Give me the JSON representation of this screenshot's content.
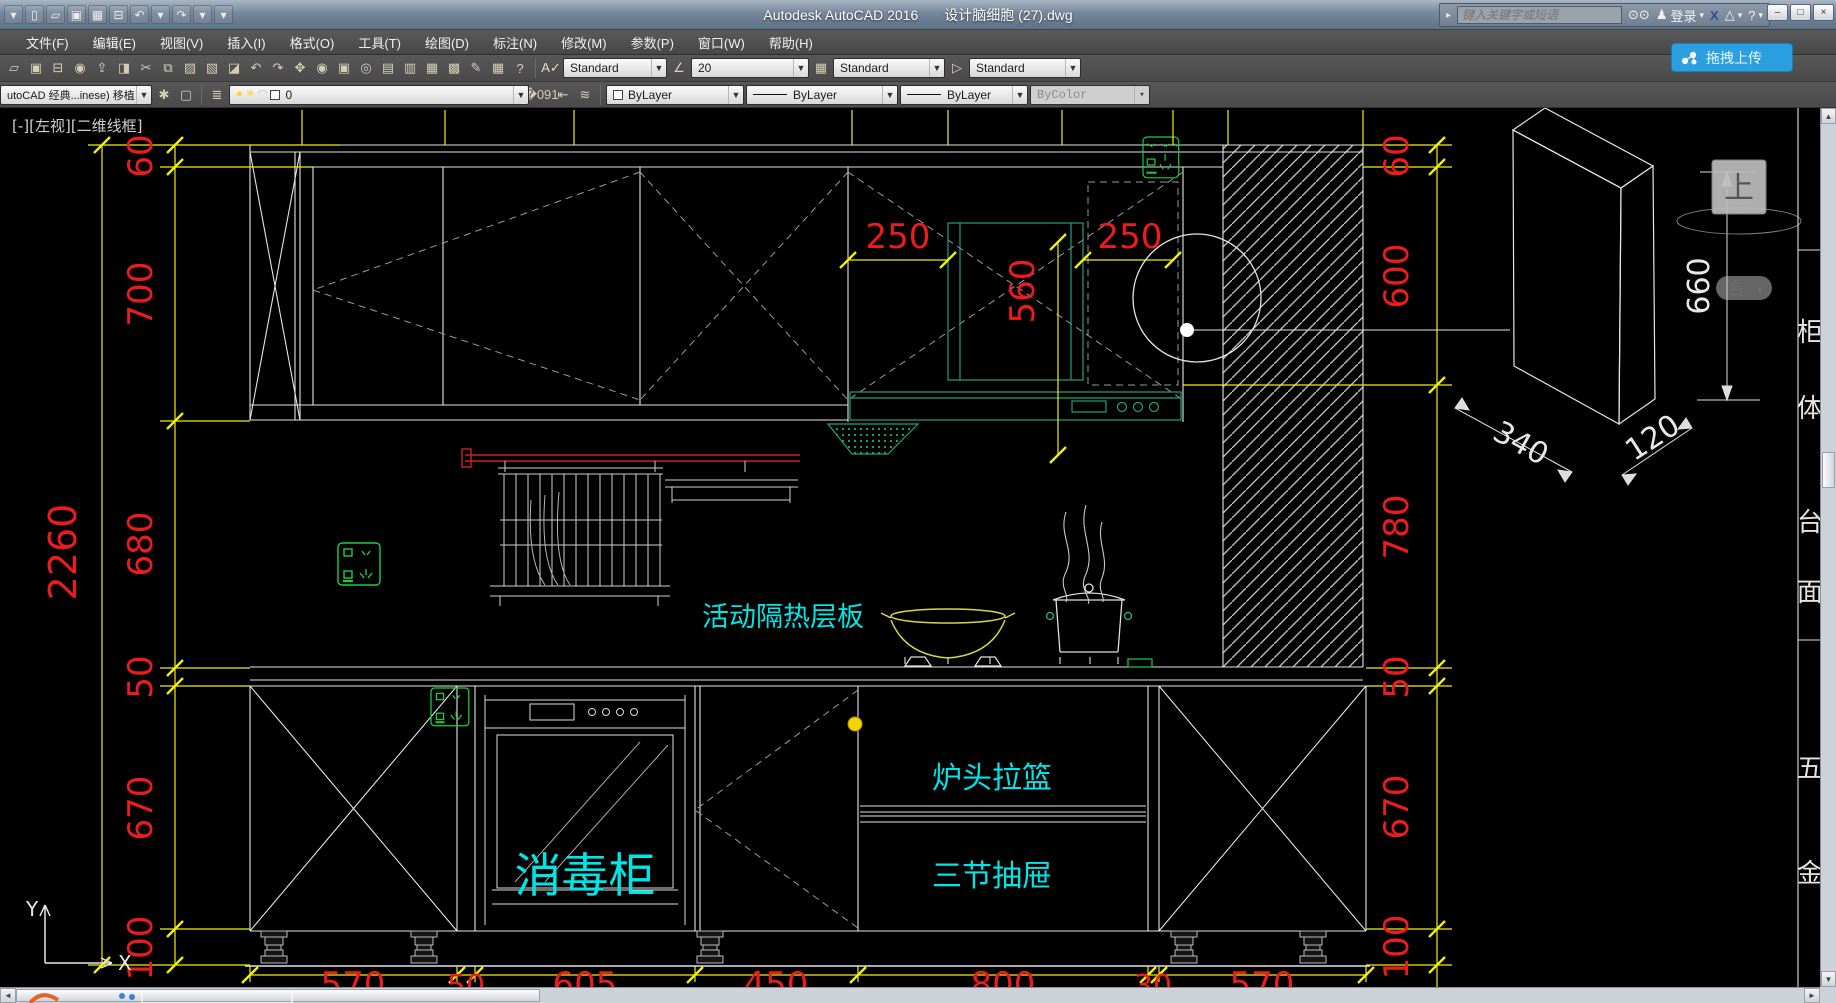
{
  "titlebar": {
    "app_title": "Autodesk AutoCAD 2016",
    "doc_name": "设计脑细胞 (27).dwg",
    "search_placeholder": "键入关键字或短语",
    "signin_label": "登录",
    "upload_label": "拖拽上传",
    "window_buttons": {
      "minimize": "–",
      "restore": "□",
      "close": "×"
    },
    "qat_icons": [
      {
        "name": "app-menu-arrow-icon",
        "glyph": "▾"
      },
      {
        "name": "new-file-icon",
        "glyph": "▯"
      },
      {
        "name": "open-file-icon",
        "glyph": "▱"
      },
      {
        "name": "save-icon",
        "glyph": "▣"
      },
      {
        "name": "save-as-icon",
        "glyph": "▦"
      },
      {
        "name": "plot-icon",
        "glyph": "⊟"
      },
      {
        "name": "undo-icon",
        "glyph": "↶"
      },
      {
        "name": "undo-dropdown-icon",
        "glyph": "▾"
      },
      {
        "name": "redo-icon",
        "glyph": "↷"
      },
      {
        "name": "redo-dropdown-icon",
        "glyph": "▾"
      },
      {
        "name": "qat-customize-icon",
        "glyph": "▾"
      }
    ],
    "infocenter_icons": [
      {
        "name": "search-binoculars-icon",
        "glyph": "⊙"
      },
      {
        "name": "sign-in-user-icon",
        "glyph": "♟"
      },
      {
        "name": "exchange-apps-icon",
        "glyph": "X"
      },
      {
        "name": "autodesk360-icon",
        "glyph": "▲"
      },
      {
        "name": "help-icon",
        "glyph": "?"
      }
    ]
  },
  "menubar": {
    "items": [
      "文件(F)",
      "编辑(E)",
      "视图(V)",
      "插入(I)",
      "格式(O)",
      "工具(T)",
      "绘图(D)",
      "标注(N)",
      "修改(M)",
      "参数(P)",
      "窗口(W)",
      "帮助(H)"
    ]
  },
  "toolbars": {
    "standard_icons": [
      {
        "name": "open-file-icon",
        "glyph": "▱"
      },
      {
        "name": "save-icon",
        "glyph": "▣"
      },
      {
        "name": "plot-icon",
        "glyph": "⊟"
      },
      {
        "name": "plot-preview-icon",
        "glyph": "◉"
      },
      {
        "name": "publish-icon",
        "glyph": "⇪"
      },
      {
        "name": "3d-dwf-icon",
        "glyph": "◨"
      },
      {
        "name": "cut-icon",
        "glyph": "✂"
      },
      {
        "name": "copy-icon",
        "glyph": "⧉"
      },
      {
        "name": "paste-icon",
        "glyph": "▨"
      },
      {
        "name": "match-properties-icon",
        "glyph": "▧"
      },
      {
        "name": "block-editor-icon",
        "glyph": "◪"
      },
      {
        "name": "undo-icon",
        "glyph": "↶"
      },
      {
        "name": "redo-icon",
        "glyph": "↷"
      },
      {
        "name": "pan-icon",
        "glyph": "✥"
      },
      {
        "name": "zoom-realtime-icon",
        "glyph": "◉"
      },
      {
        "name": "zoom-window-icon",
        "glyph": "▣"
      },
      {
        "name": "zoom-previous-icon",
        "glyph": "◎"
      },
      {
        "name": "properties-palette-icon",
        "glyph": "▤"
      },
      {
        "name": "design-center-icon",
        "glyph": "▥"
      },
      {
        "name": "tool-palettes-icon",
        "glyph": "▦"
      },
      {
        "name": "sheet-set-manager-icon",
        "glyph": "▩"
      },
      {
        "name": "markup-icon",
        "glyph": "✎"
      },
      {
        "name": "quick-calc-icon",
        "glyph": "▦"
      },
      {
        "name": "help-icon",
        "glyph": "?"
      }
    ],
    "text_style_label": "Standard",
    "dim_style_label": "20",
    "table_style_label": "Standard",
    "mleader_style_label": "Standard",
    "workspace_label": "utoCAD 经典...inese) 移植",
    "workspace_icons": [
      {
        "name": "workspace-settings-gear-icon",
        "glyph": "✱"
      },
      {
        "name": "ui-lock-icon",
        "glyph": "▢"
      }
    ],
    "layer_group_icons": [
      {
        "name": "layer-properties-manager-icon",
        "glyph": "≣"
      }
    ],
    "layer_state_icons": [
      {
        "name": "layer-on-bulb-icon",
        "glyph": "●"
      },
      {
        "name": "layer-thaw-sun-icon",
        "glyph": "✳"
      },
      {
        "name": "layer-unlock-icon",
        "glyph": "◠"
      }
    ],
    "layer_name": "0",
    "layer_tool_icons": [
      {
        "name": "make-object-layer-current-icon",
        "glyph": "�091"
      },
      {
        "name": "layer-previous-icon",
        "glyph": "⇤"
      },
      {
        "name": "layer-states-icon",
        "glyph": "≋"
      }
    ],
    "color_label": "ByLayer",
    "linetype_label": "ByLayer",
    "lineweight_label": "ByLayer",
    "plot_style_label": "ByColor"
  },
  "drawing": {
    "viewport_label": "[-][左视][二维线框]",
    "ucs": {
      "x_label": "X",
      "y_label": "Y"
    },
    "labels": {
      "insulation_shelf": "活动隔热层板",
      "sterilizer": "消毒柜",
      "stove_basket": "炉头拉篮",
      "three_drawer": "三节抽屉"
    },
    "dims": {
      "left_overall": "2260",
      "left": [
        "60",
        "700",
        "680",
        "50",
        "670",
        "100"
      ],
      "right": [
        "60",
        "600",
        "780",
        "50",
        "670",
        "100"
      ],
      "top": [
        "250",
        "560",
        "250"
      ],
      "bottom": [
        "570",
        "50",
        "605",
        "450",
        "800",
        "30",
        "570"
      ],
      "detail": {
        "width": "340",
        "depth": "120",
        "height": "660"
      }
    },
    "side_table_chars": [
      "柜",
      "体",
      "台",
      "面",
      "五",
      "金"
    ],
    "viewcube": {
      "top_label": "上",
      "menu_label": "名",
      "menu_caret": "▾"
    },
    "colors": {
      "dim_yellow": "#f1ef0c",
      "dim_red": "#ed1c1c",
      "label_cyan": "#00e5e5",
      "fixture_green": "#19cf3f",
      "hood_teal": "#22a07e",
      "line_white": "#e4e4e4",
      "rail_red": "#cc2222"
    }
  },
  "scrollbars": {
    "up": "▲",
    "down": "▼",
    "left": "◄",
    "right": "►"
  }
}
